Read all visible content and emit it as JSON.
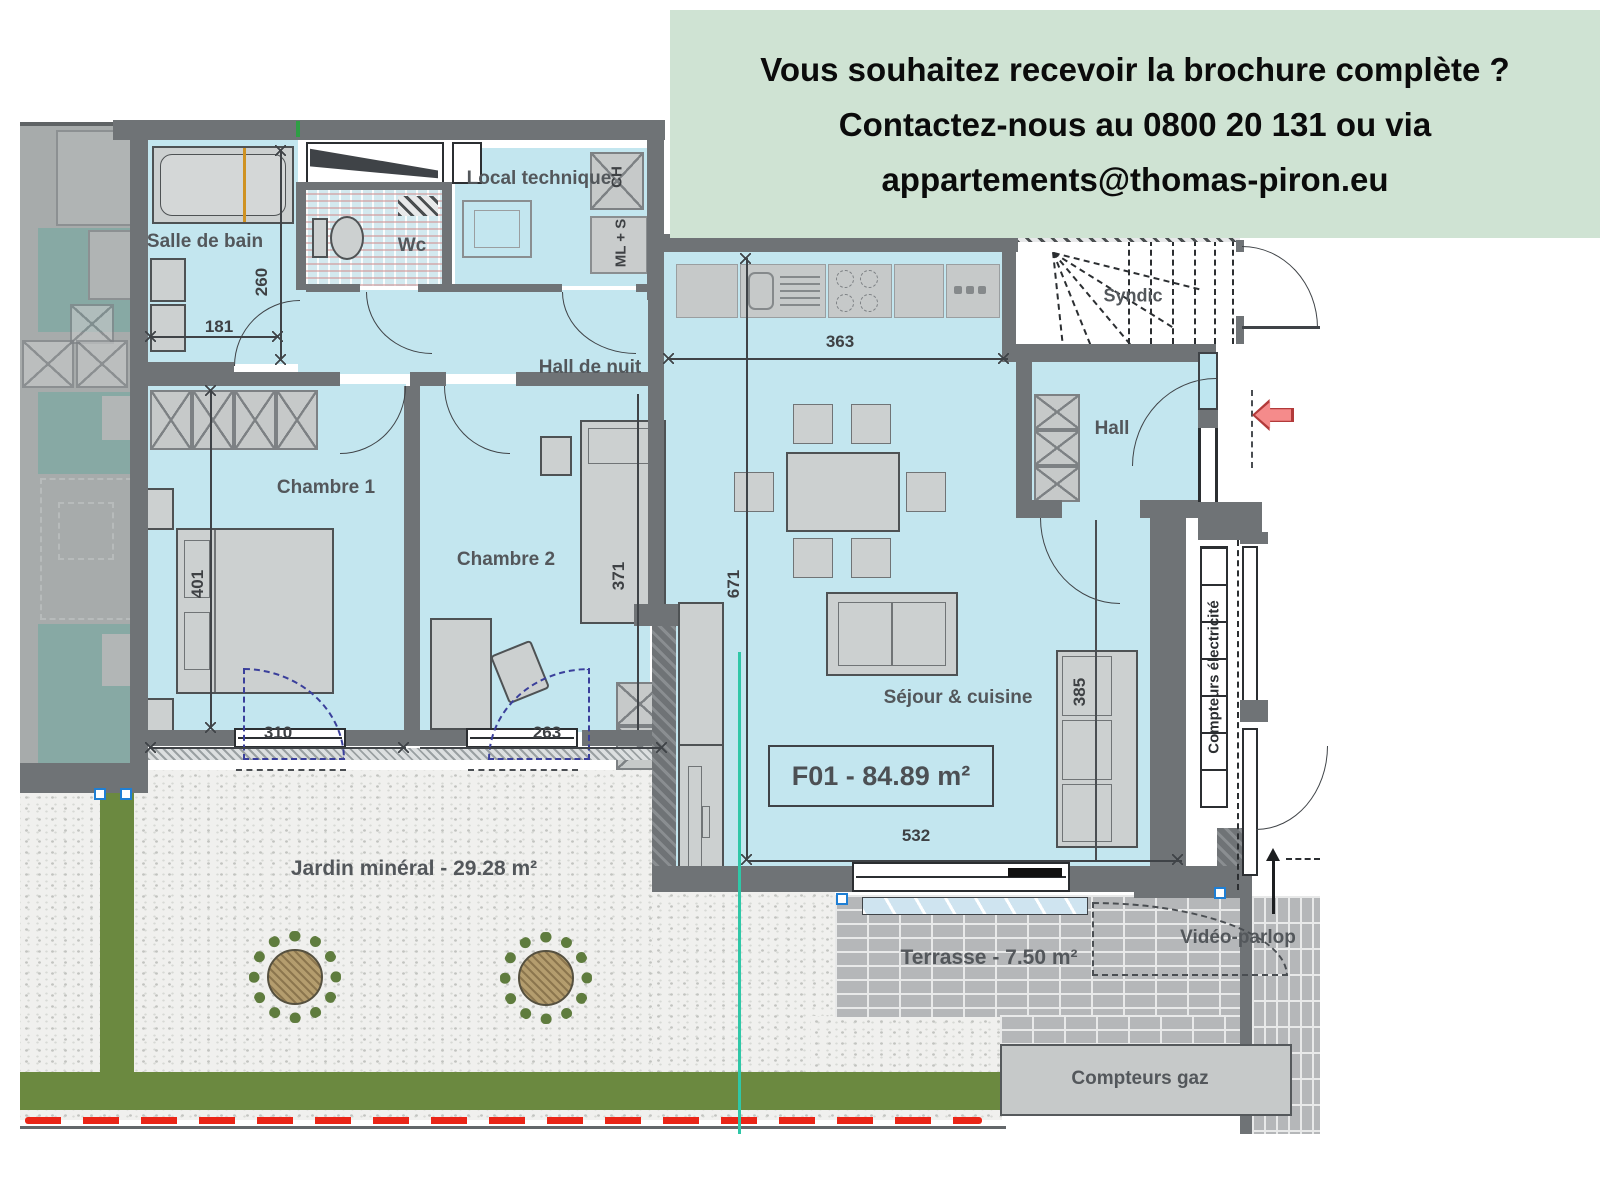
{
  "banner": {
    "bg": "#cfe3d3",
    "line1": "Vous souhaitez recevoir la brochure complète ?",
    "line2": "Contactez-nous au 0800 20 131 ou via",
    "line3": "appartements@thomas-piron.eu"
  },
  "plan": {
    "unit": {
      "label": "F01 - 84.89 m²"
    },
    "rooms": {
      "salle_de_bain": "Salle de bain",
      "wc": "Wc",
      "local_technique": "Local technique",
      "hall_de_nuit": "Hall de nuit",
      "chambre1": "Chambre 1",
      "chambre2": "Chambre 2",
      "sejour_cuisine": "Séjour & cuisine",
      "hall": "Hall",
      "syndic": "Syndic"
    },
    "outdoor": {
      "jardin": "Jardin minéral - 29.28 m²",
      "terrasse": "Terrasse - 7.50 m²"
    },
    "equipment": {
      "chauffe_eau": "CH",
      "machine_lavage": "ML + S",
      "compteurs_electricite": "Compteurs électricité",
      "compteurs_gaz": "Compteurs gaz",
      "video_parlophone": "Vidéo-parlop"
    },
    "dimensions": {
      "bain_largeur": "181",
      "bain_profondeur": "260",
      "chambre1_longueur": "401",
      "chambre1_largeur": "310",
      "chambre2_longueur": "371",
      "chambre2_largeur": "263",
      "cuisine_largeur": "363",
      "sejour_longueur": "671",
      "sejour_largeur": "532",
      "sofa_mur": "385"
    },
    "colors": {
      "floor": "#c3e6ef",
      "wall": "#6f7376",
      "banner_bg": "#cfe3d3",
      "entrance_arrow": "#f58b8b",
      "limit_line": "#ea2517",
      "garden_green": "#6b8940",
      "marker_teal": "#2fc7a7"
    }
  }
}
